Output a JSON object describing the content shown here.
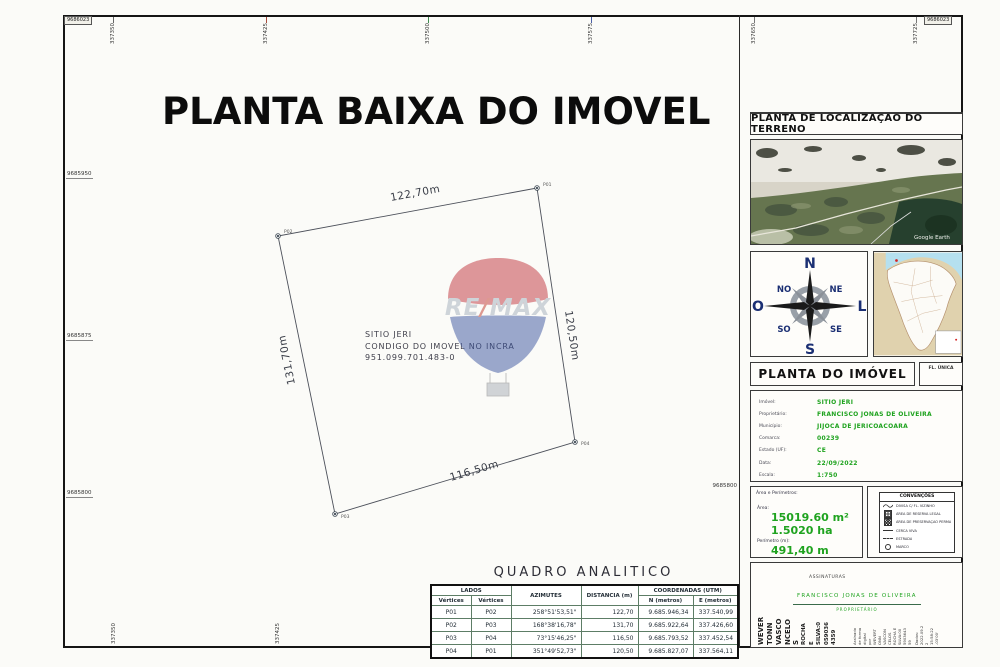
{
  "title": "PLANTA BAIXA DO IMOVEL",
  "watermark": {
    "re": "RE",
    "slash": "/",
    "max": "MAX"
  },
  "grid": {
    "corner_top_left": "9686023",
    "corner_top_right": "9686023",
    "top_ticks": [
      "337350",
      "337425",
      "337500",
      "337575",
      "337650",
      "337725"
    ],
    "left_ticks": [
      "9685950",
      "9685875",
      "9685800"
    ],
    "bottom_ticks": [
      "337350",
      "337425"
    ],
    "right_tick": "9685800"
  },
  "parcel": {
    "edge_top": "122,70m",
    "edge_right": "120,50m",
    "edge_left": "131,70m",
    "edge_bottom": "116,50m",
    "v1": "P01",
    "v2": "P02",
    "v3": "P03",
    "v4": "P04",
    "center_line1": "SITIO JERI",
    "center_line2": "CONDIGO DO IMOVEL NO INCRA",
    "center_line3": "951.099.701.483-0"
  },
  "right_panel": {
    "location_title": "PLANTA DE LOCALIZAÇAO DO TERRENO",
    "satellite_credit": "Google Earth",
    "compass": {
      "n": "N",
      "s": "S",
      "e": "L",
      "w": "O",
      "ne": "NE",
      "nw": "NO",
      "se": "SE",
      "sw": "SO"
    },
    "plant_title": "PLANTA DO IMÓVEL",
    "sheet_note": "FL. ÚNICA",
    "details": [
      {
        "label": "Imóvel:",
        "value": "SITIO JERI"
      },
      {
        "label": "Proprietário:",
        "value": "FRANCISCO JONAS DE OLIVEIRA"
      },
      {
        "label": "Município:",
        "value": "JIJOCA DE JERICOACOARA"
      },
      {
        "label": "Comarca:",
        "value": "00239"
      },
      {
        "label": "Estado (UF):",
        "value": "CE"
      },
      {
        "label": "Data:",
        "value": "22/09/2022"
      },
      {
        "label": "Escala:",
        "value": "1:750"
      }
    ],
    "area_box": {
      "header": "Área e Perímetros:",
      "area_label": "Área:",
      "area_m2": "15019.60 m²",
      "area_ha": "1.5020 ha",
      "perimeter_label": "Perímetro (m):",
      "perimeter_value": "491,40 m"
    },
    "legend": {
      "title": "CONVENÇÕES",
      "items": [
        {
          "label": "DIVISA C/ FL. VIZINHO"
        },
        {
          "label": "ÁREA DE RESERVA LEGAL"
        },
        {
          "label": "ÁREA DE PRESERVAÇÃO PERMANENTE"
        },
        {
          "label": "CERCA VIVA"
        },
        {
          "label": "ESTRADA"
        },
        {
          "label": "MARCO"
        }
      ]
    },
    "signatures": {
      "header": "ASSINATURAS",
      "name": "FRANCISCO JONAS DE OLIVEIRA",
      "role": "PROPRIETÁRIO",
      "digital_big": [
        "WEVER",
        "TONN",
        "VASCO",
        "NCELO",
        "S"
      ],
      "digital_mid": [
        "ROCHA",
        "E",
        "SILVA:0",
        "059036",
        "4359"
      ],
      "digital_small": [
        "Assinado",
        "de forma",
        "digital",
        "por",
        "WEVERT",
        "ONN",
        "VASCON",
        "CELOS",
        "ROCHA E",
        "SILVA:00",
        "5903643",
        "59",
        "Dados:",
        "2022.09.2",
        "2",
        "15:58:22",
        "-03'00'"
      ]
    }
  },
  "table": {
    "title": "QUADRO ANALITICO",
    "h_lados": "LADOS",
    "h_vertices1": "Vértices",
    "h_vertices2": "Vértices",
    "h_azimutes": "AZIMUTES",
    "h_distancia": "DISTANCIA (m)",
    "h_coord": "COORDENADAS (UTM)",
    "h_n": "N (metros)",
    "h_e": "E (metros)",
    "rows": [
      [
        "P01",
        "P02",
        "258°51'53,51\"",
        "122,70",
        "9.685.946,34",
        "337.540,99"
      ],
      [
        "P02",
        "P03",
        "168°38'16,78\"",
        "131,70",
        "9.685.922,64",
        "337.426,60"
      ],
      [
        "P03",
        "P04",
        "73°15'46,25\"",
        "116,50",
        "9.685.793,52",
        "337.452,54"
      ],
      [
        "P04",
        "P01",
        "351°49'52,73\"",
        "120,50",
        "9.685.827,07",
        "337.564,11"
      ]
    ]
  }
}
